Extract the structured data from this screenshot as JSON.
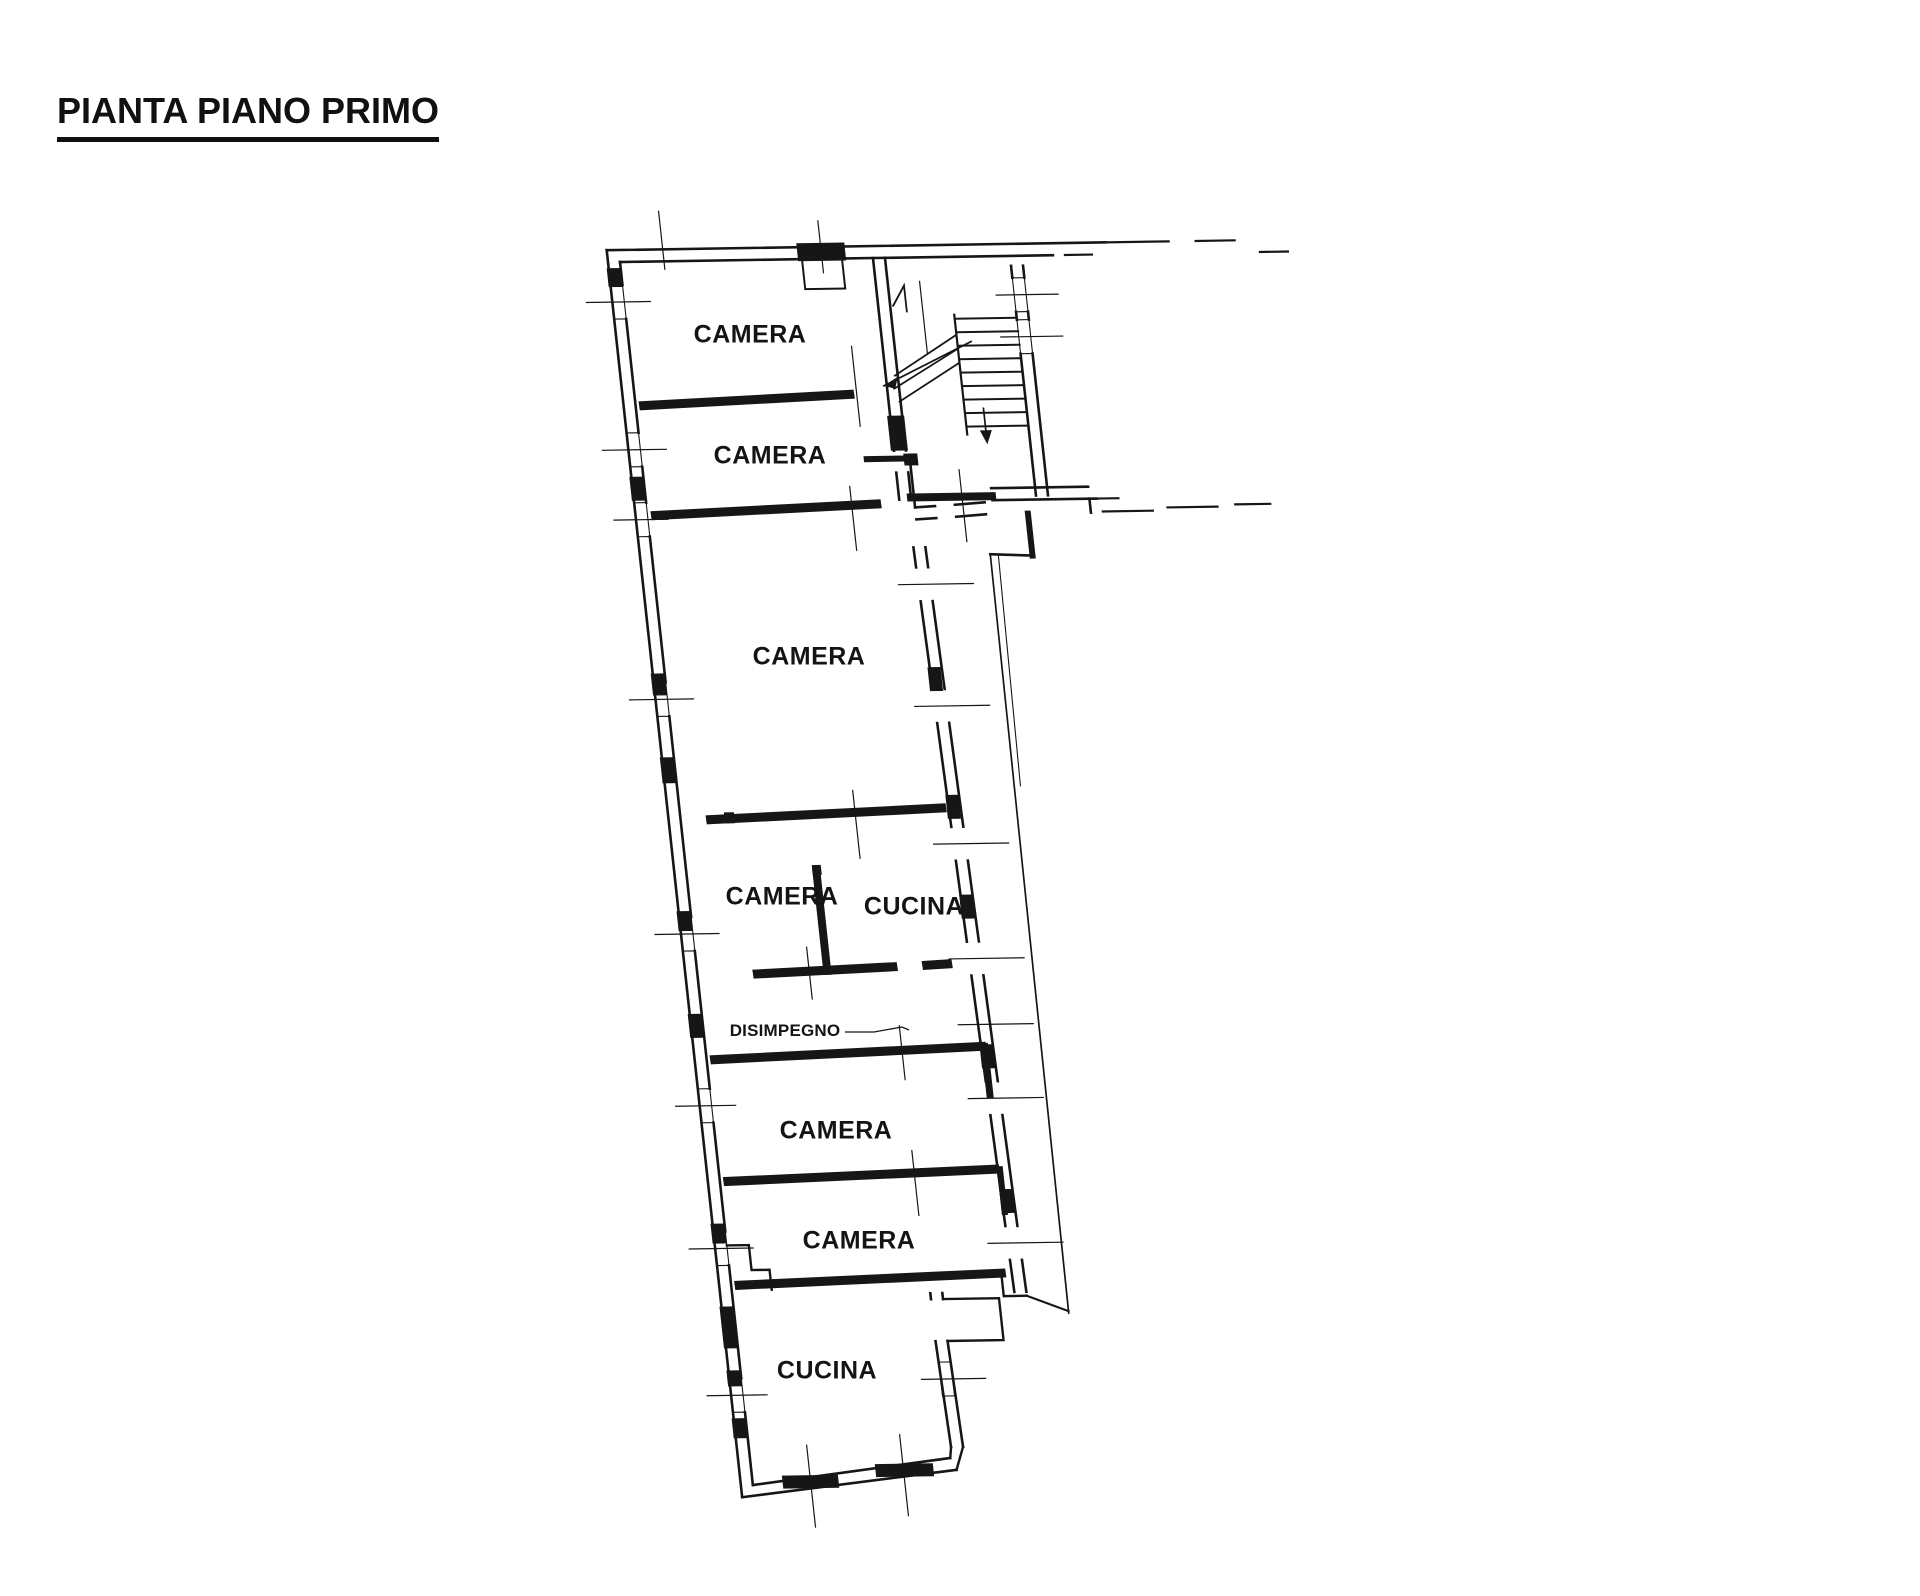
{
  "page": {
    "background_color": "#ffffff",
    "ink_color": "#161616"
  },
  "header": {
    "title": "PIANTA PIANO PRIMO"
  },
  "floor_plan": {
    "drawing_kind": "scanned black-ink architectural floor plan, slightly tilted",
    "rooms": [
      {
        "id": "camera-1",
        "label": "CAMERA"
      },
      {
        "id": "camera-2",
        "label": "CAMERA"
      },
      {
        "id": "camera-3",
        "label": "CAMERA"
      },
      {
        "id": "camera-4",
        "label": "CAMERA"
      },
      {
        "id": "cucina-1",
        "label": "CUCINA"
      },
      {
        "id": "disimpegno",
        "label": "DISIMPEGNO"
      },
      {
        "id": "camera-5",
        "label": "CAMERA"
      },
      {
        "id": "camera-6",
        "label": "CAMERA"
      },
      {
        "id": "cucina-2",
        "label": "CUCINA"
      }
    ],
    "graphic_features": [
      "staircase-with-treads-and-direction-arrow",
      "window-symbols-with-axis-ticks",
      "door-openings",
      "vent-shaft-on-top-wall",
      "dashed-party-wall-extension-lines",
      "balcony-edge-line"
    ]
  }
}
